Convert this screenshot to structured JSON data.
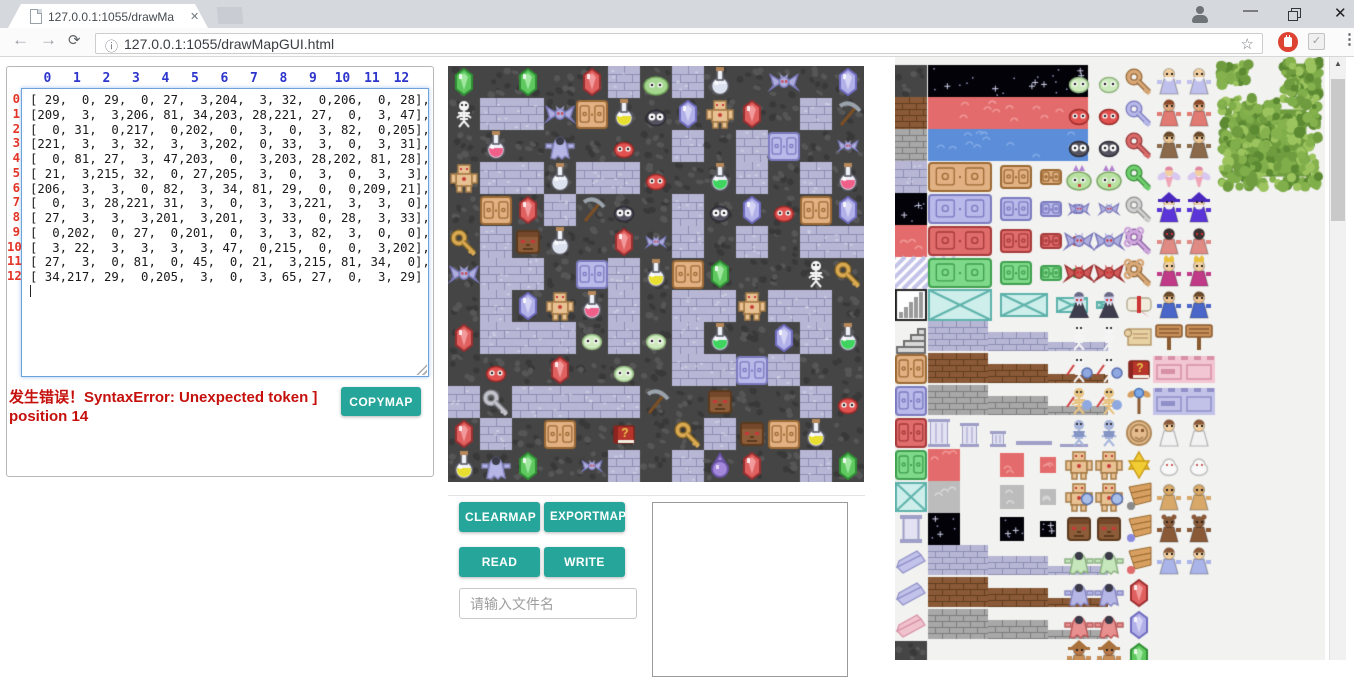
{
  "browser": {
    "tab": {
      "title": "127.0.0.1:1055/drawMa"
    },
    "url": "127.0.0.1:1055/drawMapGUI.html",
    "icons": {
      "back": "←",
      "forward": "→",
      "reload": "⟳",
      "info": "ⓘ",
      "star": "☆",
      "menu": "⋮",
      "close": "✕",
      "minimize": "—",
      "check": "✓",
      "scroll_up": "▲"
    }
  },
  "left_panel": {
    "column_headers": [
      "0",
      "1",
      "2",
      "3",
      "4",
      "5",
      "6",
      "7",
      "8",
      "9",
      "10",
      "11",
      "12"
    ],
    "row_headers": [
      "0",
      "1",
      "2",
      "3",
      "4",
      "5",
      "6",
      "7",
      "8",
      "9",
      "10",
      "11",
      "12"
    ],
    "matrix_lines": [
      "[ 29,  0, 29,  0, 27,  3,204,  3, 32,  0,206,  0, 28],",
      "[209,  3,  3,206, 81, 34,203, 28,221, 27,  0,  3, 47],",
      "[  0, 31,  0,217,  0,202,  0,  3,  0,  3, 82,  0,205],",
      "[221,  3,  3, 32,  3,  3,202,  0, 33,  3,  0,  3, 31],",
      "[  0, 81, 27,  3, 47,203,  0,  3,203, 28,202, 81, 28],",
      "[ 21,  3,215, 32,  0, 27,205,  3,  0,  3,  0,  3,  3],",
      "[206,  3,  3,  0, 82,  3, 34, 81, 29,  0,  0,209, 21],",
      "[  0,  3, 28,221, 31,  3,  0,  3,  3,221,  3,  3,  0],",
      "[ 27,  3,  3,  3,201,  3,201,  3, 33,  0, 28,  3, 33],",
      "[  0,202,  0, 27,  0,201,  0,  3,  3, 82,  3,  0,  0],",
      "[  3, 22,  3,  3,  3,  3, 47,  0,215,  0,  0,  3,202],",
      "[ 27,  3,  0, 81,  0, 45,  0, 21,  3,215, 81, 34,  0],",
      "[ 34,217, 29,  0,205,  3,  0,  3, 65, 27,  0,  3, 29]"
    ],
    "error_text": "发生错误！SyntaxError: Unexpected token ] position 14",
    "copymap_label": "COPYMAP",
    "colors": {
      "column_header": "#2d35cc",
      "row_header": "#e43427",
      "error": "#c5100c"
    }
  },
  "map": {
    "tile_size": 32,
    "grid": [
      [
        29,
        0,
        29,
        0,
        27,
        3,
        204,
        3,
        32,
        0,
        206,
        0,
        28
      ],
      [
        209,
        3,
        3,
        206,
        81,
        34,
        203,
        28,
        221,
        27,
        0,
        3,
        47
      ],
      [
        0,
        31,
        0,
        217,
        0,
        202,
        0,
        3,
        0,
        3,
        82,
        0,
        205
      ],
      [
        221,
        3,
        3,
        32,
        3,
        3,
        202,
        0,
        33,
        3,
        0,
        3,
        31
      ],
      [
        0,
        81,
        27,
        3,
        47,
        203,
        0,
        3,
        203,
        28,
        202,
        81,
        28
      ],
      [
        21,
        3,
        215,
        32,
        0,
        27,
        205,
        3,
        0,
        3,
        0,
        3,
        3
      ],
      [
        206,
        3,
        3,
        0,
        82,
        3,
        34,
        81,
        29,
        0,
        0,
        209,
        21
      ],
      [
        0,
        3,
        28,
        221,
        31,
        3,
        0,
        3,
        3,
        221,
        3,
        3,
        0
      ],
      [
        27,
        3,
        3,
        3,
        201,
        3,
        201,
        3,
        33,
        0,
        28,
        3,
        33
      ],
      [
        0,
        202,
        0,
        27,
        0,
        201,
        0,
        3,
        3,
        82,
        3,
        0,
        0
      ],
      [
        3,
        22,
        3,
        3,
        3,
        3,
        47,
        0,
        215,
        0,
        0,
        3,
        202
      ],
      [
        27,
        3,
        0,
        81,
        0,
        45,
        0,
        21,
        3,
        215,
        81,
        34,
        0
      ],
      [
        34,
        217,
        29,
        0,
        205,
        3,
        0,
        3,
        65,
        27,
        0,
        3,
        29
      ]
    ],
    "legend": {
      "0": "floor",
      "3": "brick",
      "21": "goldKey",
      "22": "grayKey",
      "27": "gemRed",
      "28": "gemBlue",
      "29": "gemGreen",
      "31": "potionRed",
      "32": "potionClear",
      "33": "potionGreen",
      "34": "potionYellow",
      "45": "book",
      "47": "pickaxe",
      "65": "orb",
      "81": "doorTan",
      "82": "doorPurple",
      "201": "slimePale",
      "202": "slimeRed",
      "203": "slimeDark",
      "204": "slimeGreen",
      "205": "batSmall",
      "206": "batBig",
      "209": "skeleton",
      "215": "stoneFace",
      "217": "ghost",
      "221": "golem"
    }
  },
  "controls": {
    "clearmap_label": "CLEARMAP",
    "exportmap_label": "EXPORTMAP",
    "read_label": "READ",
    "write_label": "WRITE",
    "filename_placeholder": "请输入文件名"
  },
  "tileset_panel": {
    "terrain_column": [
      "cobble",
      "dirt",
      "stone",
      "brickLav",
      "starTile",
      "redTile",
      "stripes",
      "barsIcon",
      "stairs",
      "doorTanT",
      "doorLavT",
      "doorRedT",
      "doorGreenT",
      "doorTealT",
      "pillarT",
      "wingLavT",
      "wingLavT",
      "wingPinkT",
      "cobble"
    ],
    "bands": [
      "starBand",
      "redBand",
      "blueBand"
    ],
    "door_rows": [
      "tan",
      "lav",
      "red",
      "green"
    ],
    "wall_step_rows": [
      "lav",
      "brown",
      "gray"
    ],
    "shrink_rows": [
      "red",
      "gray",
      "star"
    ],
    "monsters": [
      "paleSlime",
      "redSlime",
      "darkSlime",
      "crownSlime",
      "smallBat",
      "bigBat",
      "redBat",
      "vampire",
      "skeleton",
      "skelSword",
      "skelOrange",
      "skelArmor",
      "golem",
      "golemShield",
      "stoneFace",
      "ghostGreen",
      "ghostLav",
      "ghostRed",
      "hatMan"
    ],
    "items": [
      "keyTan",
      "keyLav",
      "keyRed",
      "keyGreen",
      "keyGray",
      "keyPurple",
      "keyOrnate",
      "scrollRed",
      "parchment",
      "bookRed",
      "staff",
      "medallion",
      "star6",
      "wingBoot1",
      "wingBoot2",
      "wingBoot3",
      "gemRed",
      "gemLav",
      "gemGreen"
    ],
    "characters": [
      "oldMan",
      "dwarf",
      "strongMan",
      "fairy",
      "wizard",
      "hooded",
      "king",
      "boy",
      "signpost",
      "wallPink",
      "wallLav",
      "princess",
      "eggs",
      "gingerbread",
      "bear",
      "angelBlue"
    ]
  },
  "scrollbar": {
    "thumb_top": 8,
    "thumb_height": 142
  },
  "theme": {
    "accent_teal": "#26a69a"
  }
}
